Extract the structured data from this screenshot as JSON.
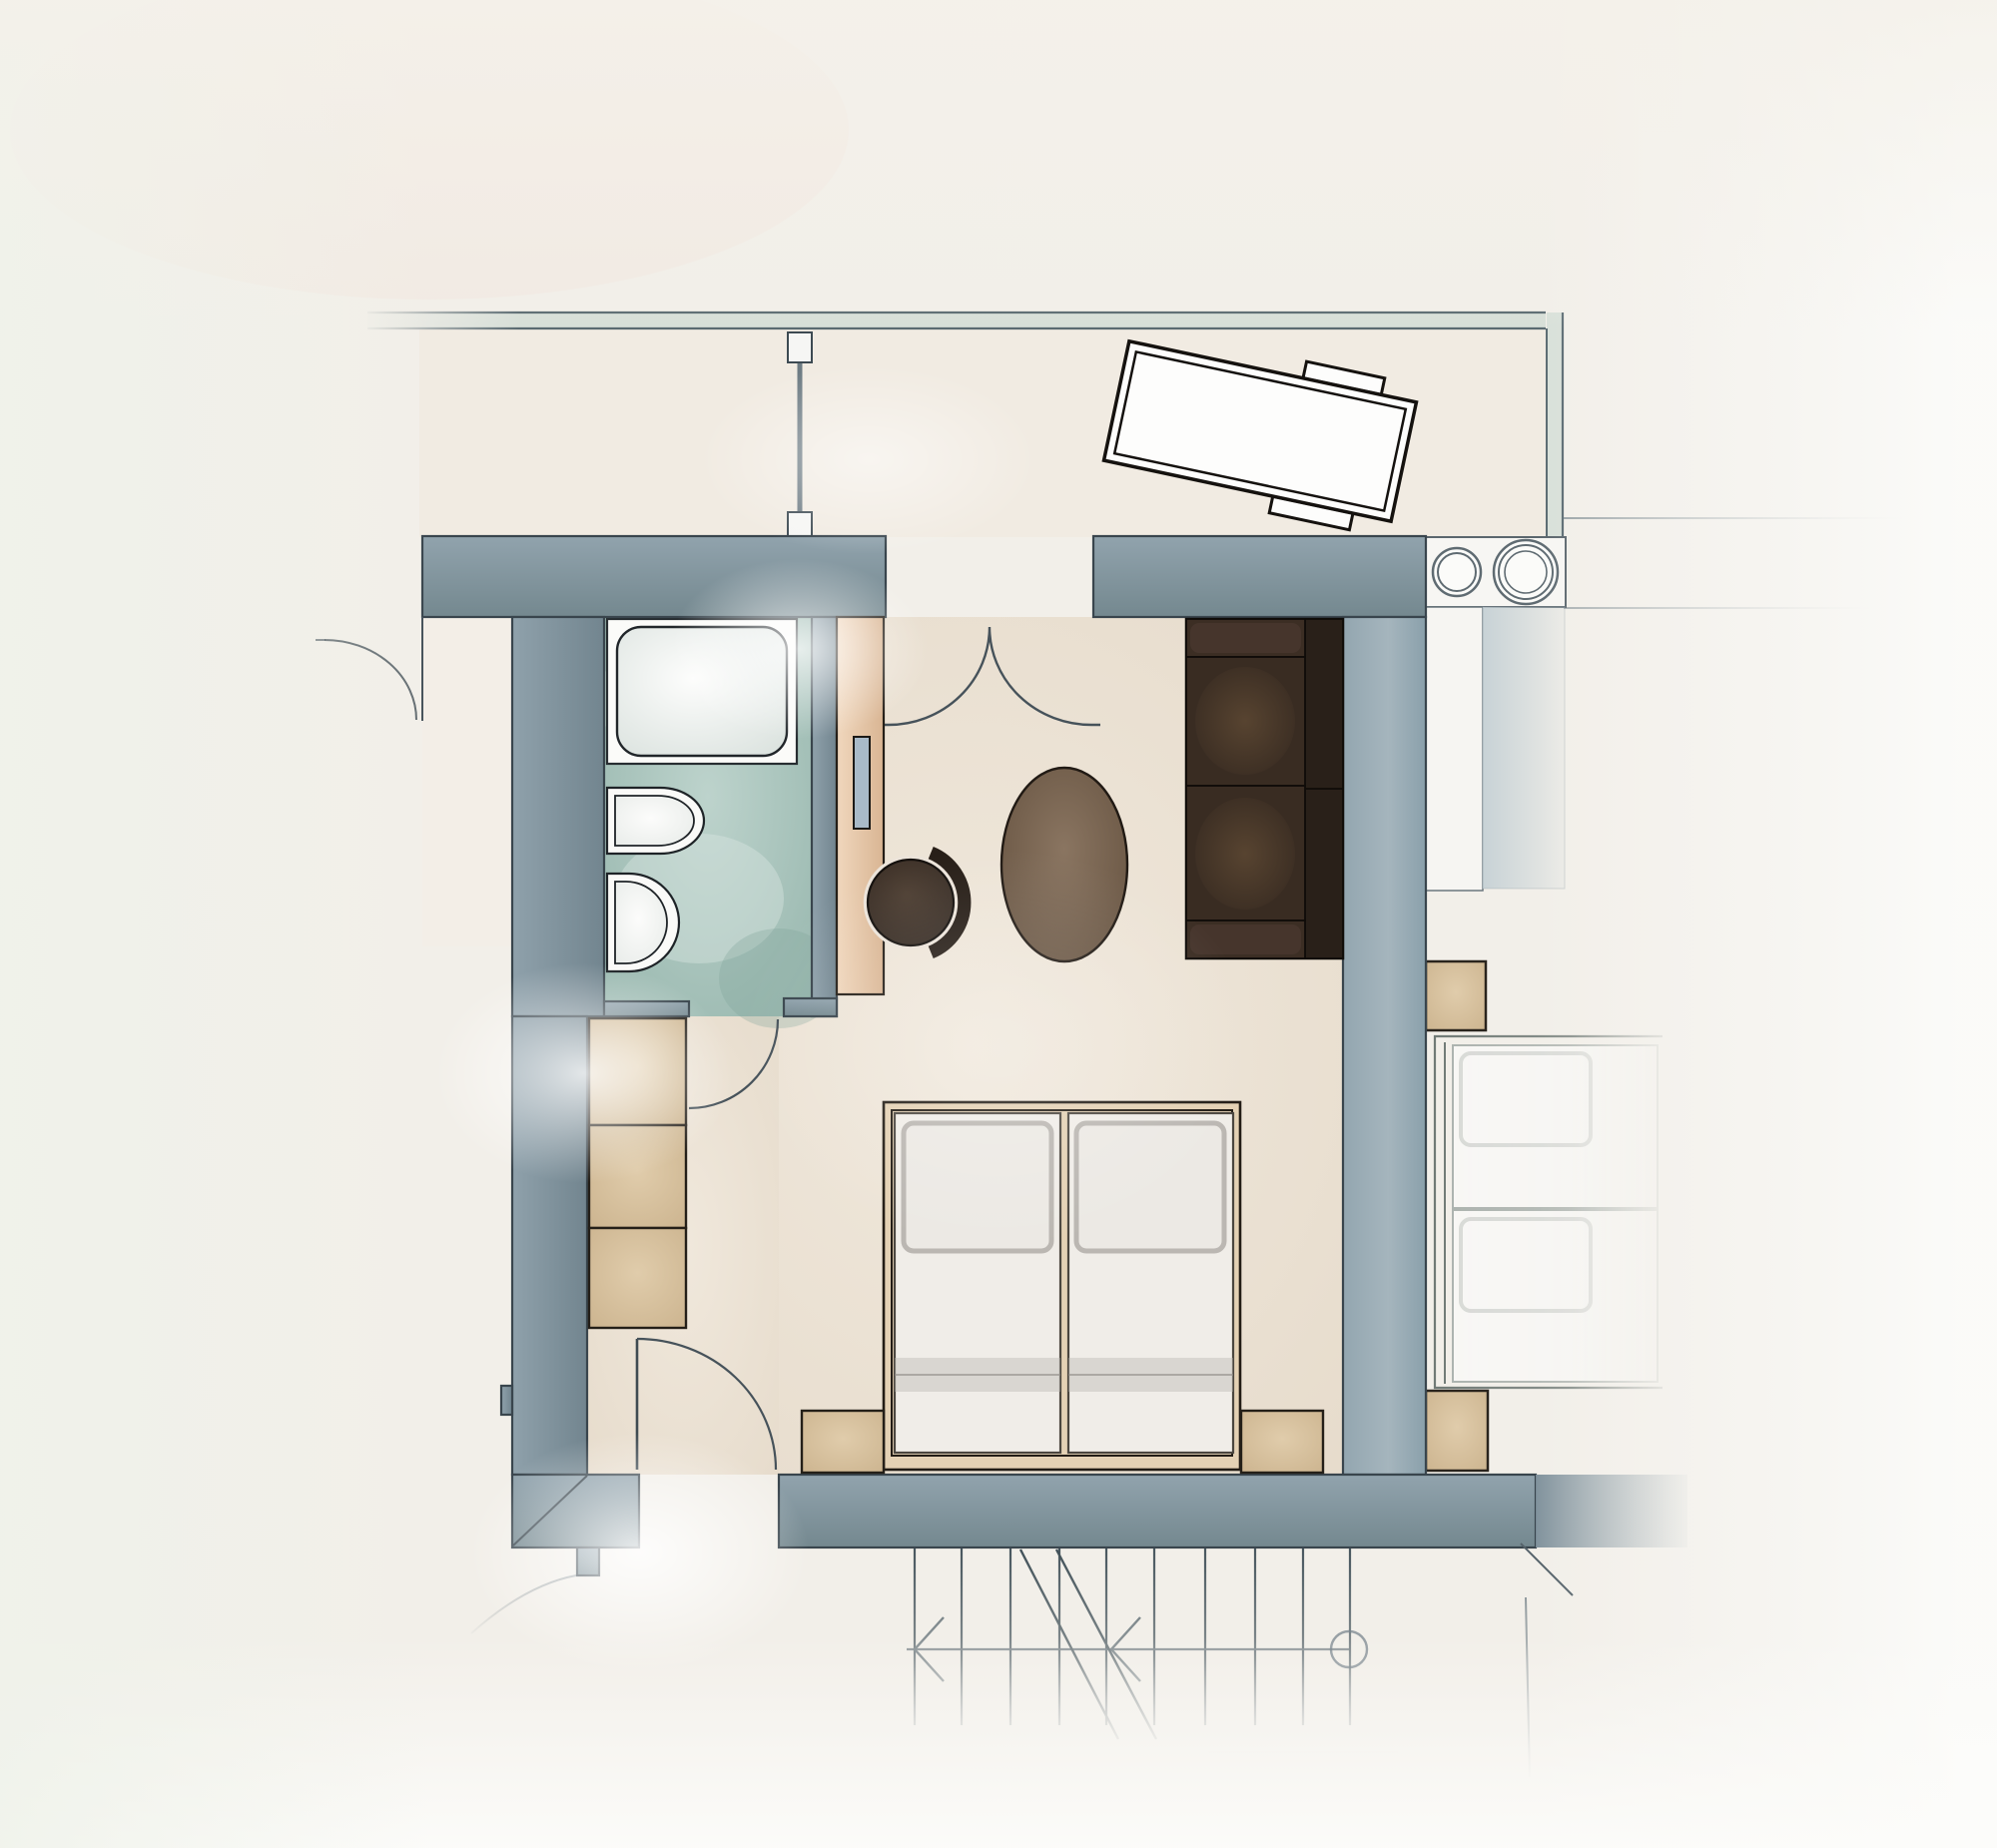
{
  "document": {
    "kind": "floor-plan",
    "render_style": "hand-drawn watercolor architectural plan",
    "visible_text": []
  },
  "palette": {
    "paper": "#f2efe9",
    "paper_edge": "#fbfbf8",
    "floor": "#ece2d4",
    "vestibule": "#f3ede5",
    "wall": "#8296a1",
    "wall_dark": "#74888f",
    "wall_light": "#9fb0b9",
    "wall_outline": "#39454d",
    "teal_floor": "#a3c0b8",
    "teal_light": "#cfdfd9",
    "fixture_white": "#fbfbf9",
    "wood_tan": "#ecd2b6",
    "wood_dark": "#d9b593",
    "wood_outline": "#241e17",
    "tv_screen": "#a9bac8",
    "beige": "#d8c3a3",
    "bed_frame": "#e4d1b4",
    "mattress": "#f0ede8",
    "mattress_shade": "#b7b3ae",
    "pillow_edge": "#b6b2ad",
    "sofa": "#33271f",
    "sofa_back": "#292019",
    "sofa_outline": "#0f0c09",
    "table_brown": "#6f5c4a",
    "chair_brown": "#3f332a",
    "chair_back": "#281f18",
    "door_line": "#46525a",
    "stair_line": "#44535b",
    "faint_line": "#8b979c",
    "railing_fill": "#d4ddd6"
  },
  "rooms": [
    {
      "name": "balcony",
      "label": "",
      "items": [
        "outdoor-table",
        "bench-top",
        "bench-bottom",
        "balcony-divider",
        "balcony-railing"
      ]
    },
    {
      "name": "bathroom",
      "label": "",
      "items": [
        "bathtub",
        "toilet",
        "bidet",
        "bathroom-door"
      ]
    },
    {
      "name": "living-bedroom",
      "label": "",
      "items": [
        "sofa",
        "coffee-table",
        "armchair",
        "tv-sideboard",
        "tv",
        "double-bed",
        "nightstand-left",
        "nightstand-right",
        "wardrobe"
      ]
    },
    {
      "name": "entry",
      "label": "",
      "items": [
        "entry-door",
        "double-swing-door"
      ]
    },
    {
      "name": "neighbor-room",
      "label": "",
      "items": [
        "kitchenette-counter",
        "sink-small",
        "sink-large",
        "neighbor-bed",
        "headboard-cabinet-top",
        "headboard-cabinet-bottom"
      ]
    },
    {
      "name": "stair-hall",
      "label": "",
      "items": [
        "staircase",
        "stair-arrow-left",
        "stair-arrow-mid",
        "stair-start-circle"
      ]
    }
  ],
  "furniture_inventory": [
    "outdoor-table",
    "bench-top",
    "bench-bottom",
    "balcony-divider",
    "balcony-railing",
    "bathtub",
    "toilet",
    "bidet",
    "wardrobe",
    "tv-sideboard",
    "tv",
    "armchair",
    "coffee-table",
    "sofa",
    "double-bed",
    "pillow",
    "nightstand-left",
    "nightstand-right",
    "kitchenette-counter",
    "sink-small",
    "sink-large",
    "neighbor-bed",
    "headboard-cabinet-top",
    "headboard-cabinet-bottom",
    "staircase"
  ]
}
